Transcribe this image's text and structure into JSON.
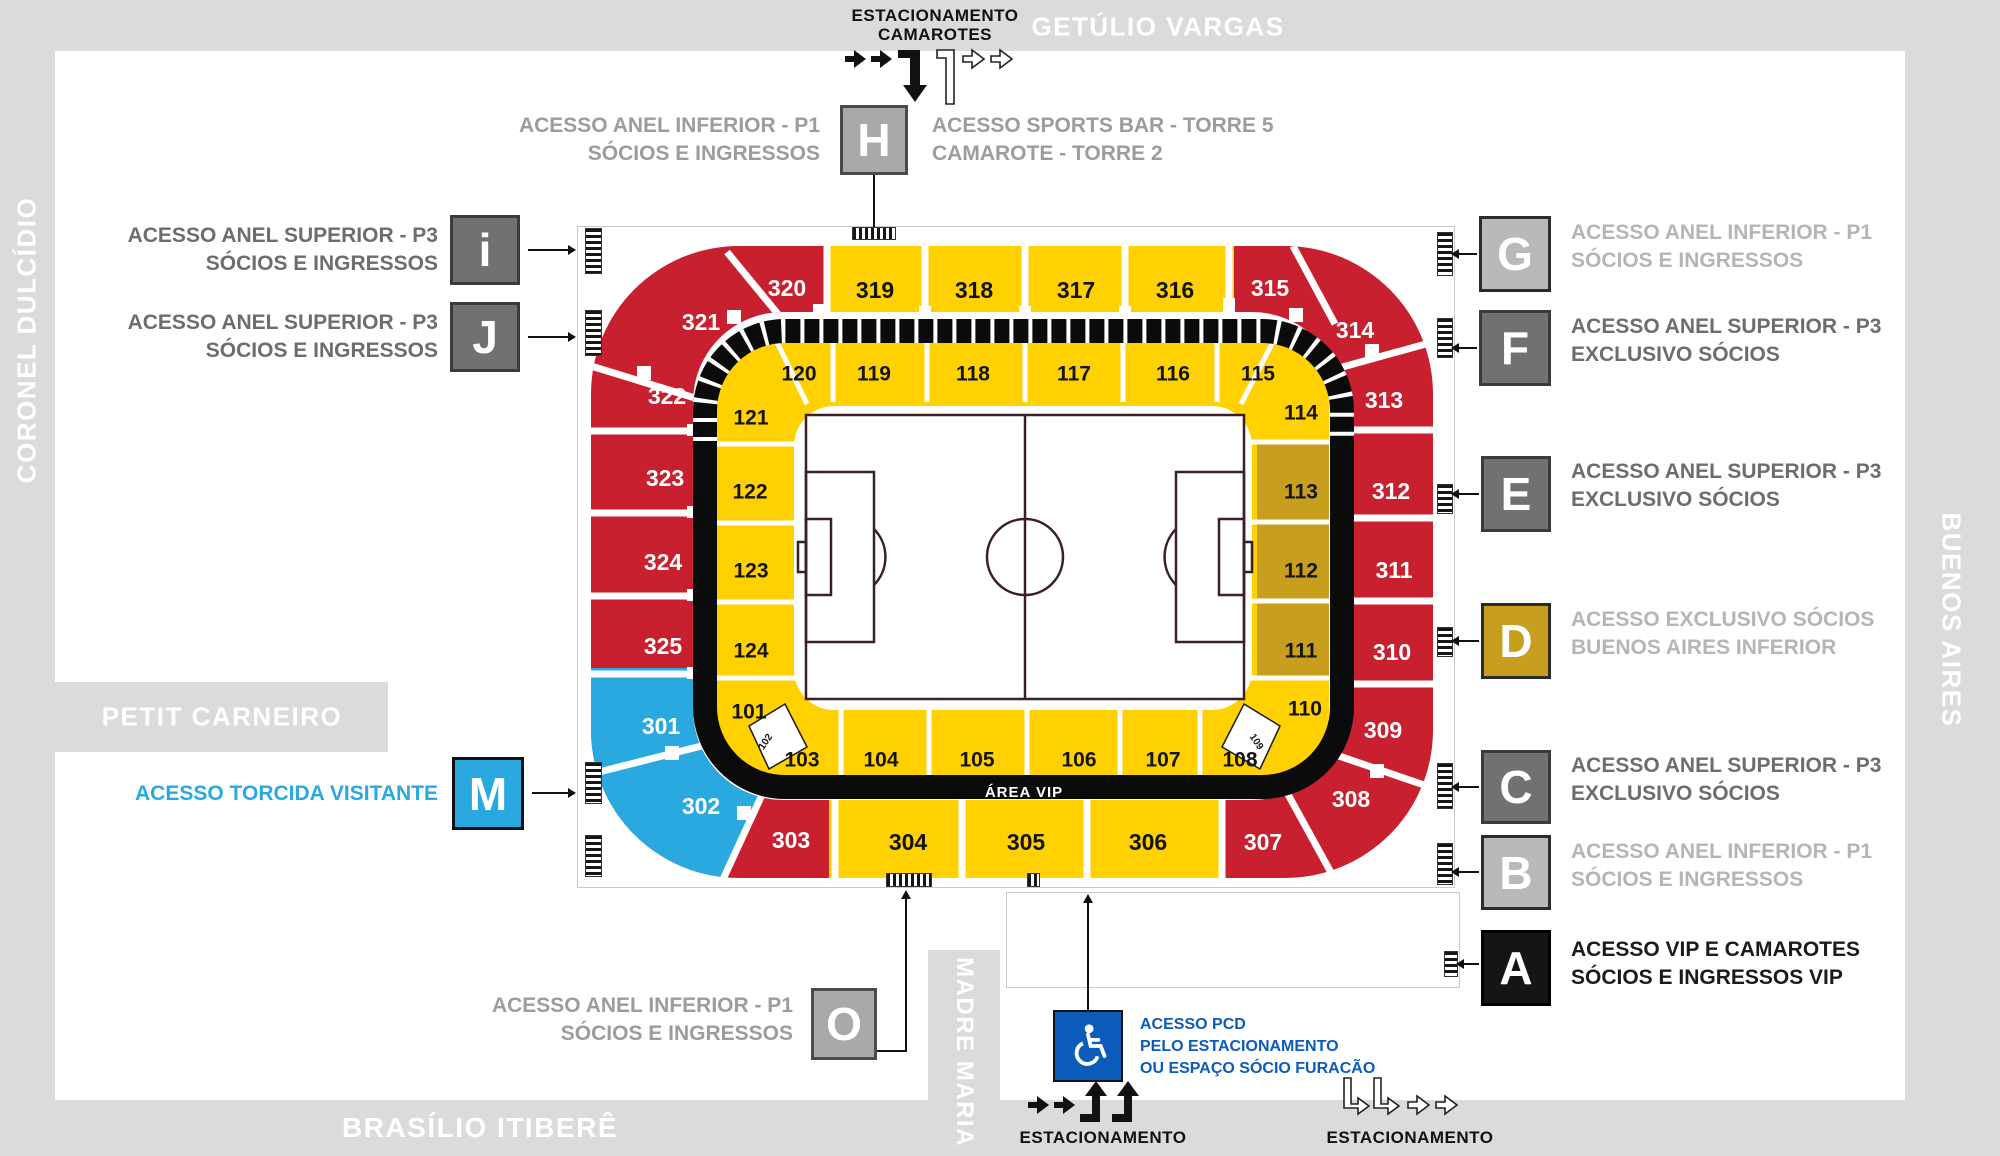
{
  "streets": {
    "top": "GETÚLIO VARGAS",
    "left": "CORONEL DULCÍDIO",
    "right": "BUENOS AIRES",
    "bottom": "BRASÍLIO ITIBERÊ",
    "petit": "PETIT CARNEIRO",
    "madre": "MADRE MARIA"
  },
  "parking_top": {
    "line1": "ESTACIONAMENTO",
    "line2": "CAMAROTES"
  },
  "parking_bottom_left": "ESTACIONAMENTO",
  "parking_bottom_right": "ESTACIONAMENTO",
  "pcd": {
    "line1": "ACESSO PCD",
    "line2": "PELO ESTACIONAMENTO",
    "line3": "OU ESPAÇO SÓCIO FURACÃO"
  },
  "area_vip": "ÁREA VIP",
  "access_points": [
    {
      "id": "i",
      "letter": "i",
      "style": "dark",
      "text_style": "dark",
      "lines": [
        "ACESSO ANEL SUPERIOR - P3",
        "SÓCIOS E INGRESSOS"
      ]
    },
    {
      "id": "J",
      "letter": "J",
      "style": "dark",
      "text_style": "dark",
      "lines": [
        "ACESSO ANEL SUPERIOR - P3",
        "SÓCIOS E INGRESSOS"
      ]
    },
    {
      "id": "M",
      "letter": "M",
      "style": "blue",
      "text_style": "blue",
      "lines": [
        "ACESSO TORCIDA VISITANTE"
      ]
    },
    {
      "id": "H",
      "letter": "H",
      "style": "mid",
      "text_style": "mid",
      "lines": [
        "ACESSO ANEL INFERIOR - P1",
        "SÓCIOS E INGRESSOS"
      ],
      "lines_right": [
        "ACESSO SPORTS BAR - TORRE 5",
        "CAMAROTE - TORRE 2"
      ]
    },
    {
      "id": "O",
      "letter": "O",
      "style": "mid",
      "text_style": "mid",
      "lines": [
        "ACESSO ANEL INFERIOR - P1",
        "SÓCIOS E INGRESSOS"
      ]
    },
    {
      "id": "G",
      "letter": "G",
      "style": "light",
      "text_style": "light",
      "lines": [
        "ACESSO ANEL INFERIOR - P1",
        "SÓCIOS E INGRESSOS"
      ]
    },
    {
      "id": "F",
      "letter": "F",
      "style": "dark",
      "text_style": "dark",
      "lines": [
        "ACESSO ANEL SUPERIOR - P3",
        "EXCLUSIVO SÓCIOS"
      ]
    },
    {
      "id": "E",
      "letter": "E",
      "style": "dark",
      "text_style": "dark",
      "lines": [
        "ACESSO ANEL SUPERIOR - P3",
        "EXCLUSIVO SÓCIOS"
      ]
    },
    {
      "id": "D",
      "letter": "D",
      "style": "gold",
      "text_style": "light",
      "lines": [
        "ACESSO EXCLUSIVO SÓCIOS",
        "BUENOS AIRES INFERIOR"
      ]
    },
    {
      "id": "C",
      "letter": "C",
      "style": "dark",
      "text_style": "dark",
      "lines": [
        "ACESSO ANEL SUPERIOR - P3",
        "EXCLUSIVO SÓCIOS"
      ]
    },
    {
      "id": "B",
      "letter": "B",
      "style": "light",
      "text_style": "light",
      "lines": [
        "ACESSO ANEL INFERIOR - P1",
        "SÓCIOS E INGRESSOS"
      ]
    },
    {
      "id": "A",
      "letter": "A",
      "style": "black",
      "text_style": "black",
      "lines": [
        "ACESSO VIP E CAMAROTES",
        "SÓCIOS E INGRESSOS VIP"
      ]
    }
  ],
  "stadium": {
    "sections": [
      {
        "n": "301",
        "c": "blue"
      },
      {
        "n": "302",
        "c": "blue"
      },
      {
        "n": "303",
        "c": "red"
      },
      {
        "n": "304",
        "c": "yellow"
      },
      {
        "n": "305",
        "c": "yellow"
      },
      {
        "n": "306",
        "c": "yellow"
      },
      {
        "n": "307",
        "c": "red"
      },
      {
        "n": "308",
        "c": "red"
      },
      {
        "n": "309",
        "c": "red"
      },
      {
        "n": "310",
        "c": "red"
      },
      {
        "n": "311",
        "c": "red"
      },
      {
        "n": "312",
        "c": "red"
      },
      {
        "n": "313",
        "c": "red"
      },
      {
        "n": "314",
        "c": "red"
      },
      {
        "n": "315",
        "c": "red"
      },
      {
        "n": "316",
        "c": "yellow"
      },
      {
        "n": "317",
        "c": "yellow"
      },
      {
        "n": "318",
        "c": "yellow"
      },
      {
        "n": "319",
        "c": "yellow"
      },
      {
        "n": "320",
        "c": "red"
      },
      {
        "n": "321",
        "c": "red"
      },
      {
        "n": "322",
        "c": "red"
      },
      {
        "n": "323",
        "c": "red"
      },
      {
        "n": "324",
        "c": "red"
      },
      {
        "n": "325",
        "c": "red"
      },
      {
        "n": "101",
        "c": "yellow"
      },
      {
        "n": "102",
        "c": "wedge"
      },
      {
        "n": "103",
        "c": "yellow"
      },
      {
        "n": "104",
        "c": "yellow"
      },
      {
        "n": "105",
        "c": "yellow"
      },
      {
        "n": "106",
        "c": "yellow"
      },
      {
        "n": "107",
        "c": "yellow"
      },
      {
        "n": "108",
        "c": "yellow"
      },
      {
        "n": "109",
        "c": "wedge"
      },
      {
        "n": "110",
        "c": "yellow"
      },
      {
        "n": "111",
        "c": "gold"
      },
      {
        "n": "112",
        "c": "gold"
      },
      {
        "n": "113",
        "c": "gold"
      },
      {
        "n": "114",
        "c": "yellow"
      },
      {
        "n": "115",
        "c": "yellow"
      },
      {
        "n": "116",
        "c": "yellow"
      },
      {
        "n": "117",
        "c": "yellow"
      },
      {
        "n": "118",
        "c": "yellow"
      },
      {
        "n": "119",
        "c": "yellow"
      },
      {
        "n": "120",
        "c": "yellow"
      },
      {
        "n": "121",
        "c": "yellow"
      },
      {
        "n": "122",
        "c": "yellow"
      },
      {
        "n": "123",
        "c": "yellow"
      },
      {
        "n": "124",
        "c": "yellow"
      }
    ]
  },
  "colors": {
    "red": "#C8202F",
    "yellow": "#FFD100",
    "gold": "#C79E1E",
    "blue": "#29A9E0",
    "ring_black": "#0B0B0B",
    "pcd_blue": "#0A5BBA",
    "band_gray": "#DBDBDB"
  }
}
